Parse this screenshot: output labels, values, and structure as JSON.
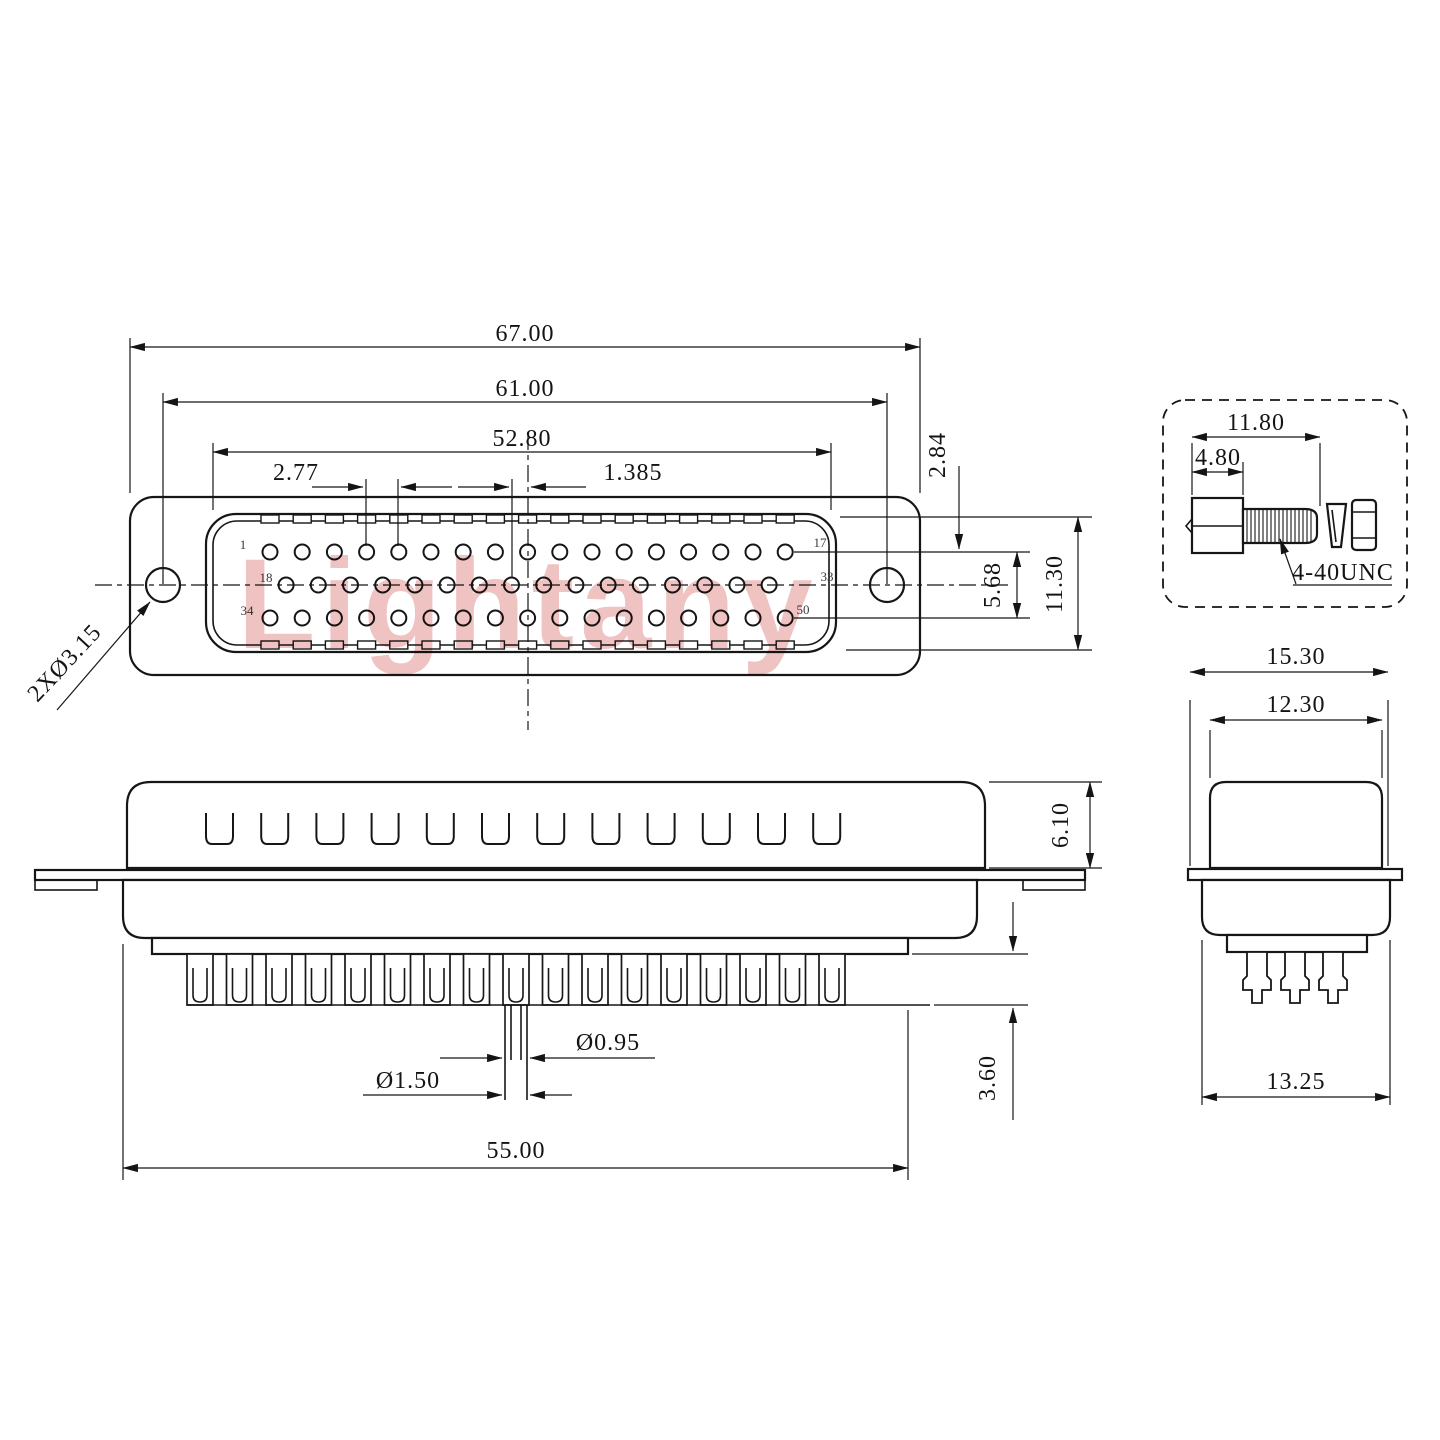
{
  "drawing": {
    "watermark": "Lightany",
    "front_view": {
      "dims": {
        "overall_width": "67.00",
        "hole_span": "61.00",
        "insert_width": "52.80",
        "pin_pitch": "2.77",
        "half_pitch": "1.385",
        "row_offset": "2.84",
        "row_span": "5.68",
        "insert_height": "11.30",
        "mount_hole": "2XØ3.15"
      },
      "pin_labels": {
        "first_top": "1",
        "last_top": "17",
        "first_mid": "18",
        "last_mid": "33",
        "first_bot": "34",
        "last_bot": "50"
      },
      "pin_rows": [
        {
          "count": 17
        },
        {
          "count": 16
        },
        {
          "count": 17
        }
      ]
    },
    "side_view": {
      "dims": {
        "shell_height": "6.10",
        "cup_height": "3.60",
        "pin_dia": "Ø0.95",
        "cup_dia": "Ø1.50",
        "body_width": "55.00"
      },
      "slot_count": 12,
      "tooth_count": 17
    },
    "end_view": {
      "dims": {
        "flange_width": "15.30",
        "shell_width": "12.30",
        "body_width": "13.25"
      },
      "pin_count": 3
    },
    "screw_detail": {
      "dims": {
        "total_length": "11.80",
        "head_length": "4.80"
      },
      "thread_label": "4-40UNC"
    }
  }
}
